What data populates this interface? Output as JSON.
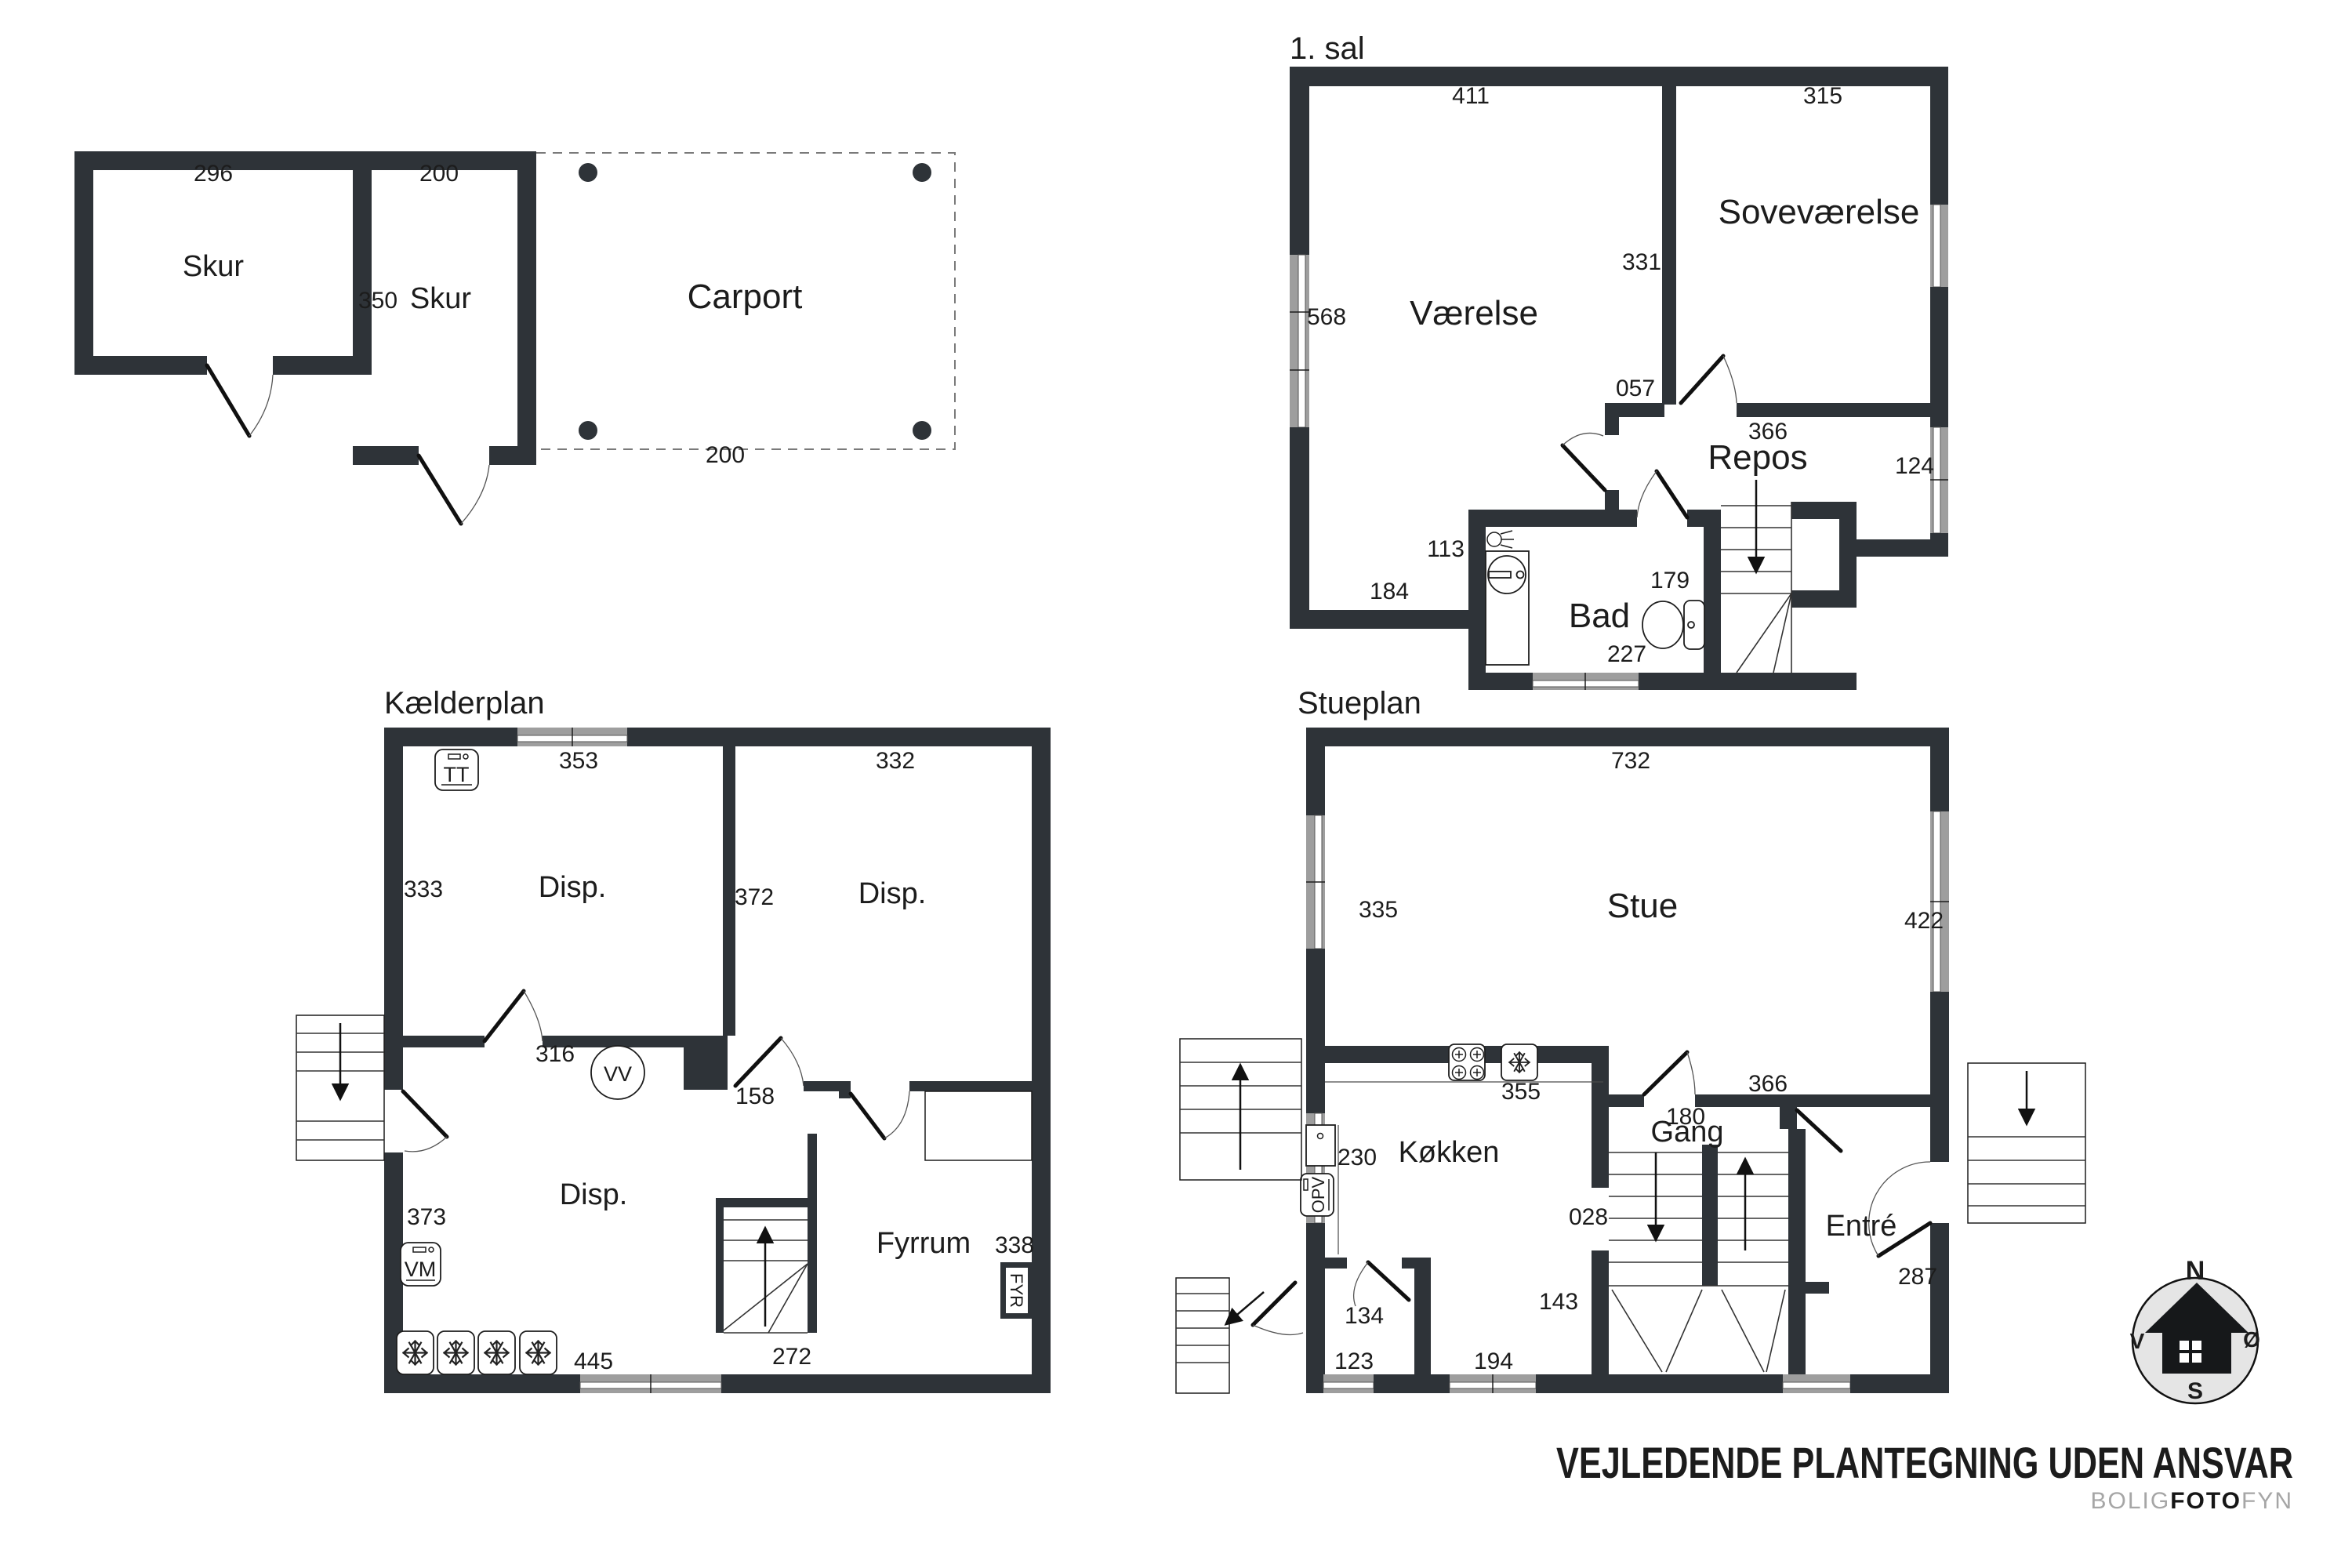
{
  "footer": {
    "disclaimer": "VEJLEDENDE PLANTEGNING UDEN ANSVAR",
    "brand": {
      "bolig": "BOLIG",
      "foto": "FOTO",
      "fyn": "FYN"
    }
  },
  "compass": {
    "north": "N",
    "south": "S",
    "east": "Ø",
    "west": "V"
  },
  "colors": {
    "wall": "#2e3338",
    "window_gray": "#9e9e9e",
    "compass_fill": "#e5e5e5",
    "text": "#1c1c1c"
  },
  "plans": {
    "outbuilding": {
      "rooms": {
        "shed1": "Skur",
        "shed2": "Skur",
        "carport": "Carport"
      },
      "dims": {
        "shed1_width": "296",
        "shed2_width": "200",
        "shed2_depth": "350",
        "carport_width": "200"
      }
    },
    "first_floor": {
      "title": "1. sal",
      "rooms": {
        "room": "Værelse",
        "bedroom": "Soveværelse",
        "landing": "Repos",
        "bath": "Bad"
      },
      "dims": {
        "room_width": "411",
        "bedroom_width": "315",
        "room_height": "331",
        "room_side": "568",
        "landing_door": "057",
        "landing_width": "366",
        "landing_window": "124",
        "bath_side": "113",
        "room_bottom": "184",
        "stair": "179",
        "bath_width": "227"
      }
    },
    "basement": {
      "title": "Kælderplan",
      "rooms": {
        "disp1": "Disp.",
        "disp2": "Disp.",
        "disp3": "Disp.",
        "boiler_room": "Fyrrum"
      },
      "dims": {
        "disp1_width": "353",
        "disp2_width": "332",
        "disp1_side": "333",
        "disp2_side": "372",
        "door1": "316",
        "door2": "158",
        "side": "373",
        "bottom": "445",
        "boiler_width": "272",
        "boiler_side": "338"
      },
      "icons": {
        "tumble_dryer": "TT",
        "water_heater": "VV",
        "washing_machine": "VM",
        "boiler": "FYR"
      }
    },
    "ground_floor": {
      "title": "Stueplan",
      "rooms": {
        "living": "Stue",
        "kitchen": "Køkken",
        "hall": "Gang",
        "entry": "Entré"
      },
      "dims": {
        "living_width": "732",
        "living_side": "335",
        "living_right": "422",
        "kitchen_width": "355",
        "kitchen_side": "230",
        "hall_width": "366",
        "hall_door": "180",
        "under_stairs": "028",
        "stair_width": "143",
        "room134": "134",
        "window1": "123",
        "window2": "194",
        "entry_door": "287"
      },
      "icons": {
        "dishwasher": "OPV"
      }
    }
  }
}
